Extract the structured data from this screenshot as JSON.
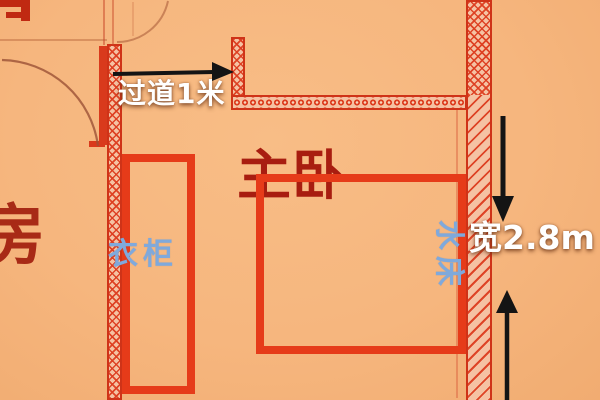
{
  "floorplan": {
    "annotations": {
      "corridor_dimension": "过道1米",
      "width_dimension": "宽2.8m"
    },
    "rooms": {
      "master_bedroom": "主卧",
      "adjacent_room_partial": "房"
    },
    "furniture": {
      "wardrobe": "衣柜",
      "bed": "水床"
    },
    "icons": {
      "arrow_right": "black arrow pointing right along corridor",
      "arrow_down": "black arrow pointing down (top of width dimension)",
      "arrow_up": "black arrow pointing up (bottom of width dimension)",
      "door_swing_arc": "quarter-circle door swing",
      "hatched_wall": "red hatched structural wall"
    },
    "colors": {
      "background": "#f6b67e",
      "wall_red": "#cf3318",
      "wall_fill": "#f5c2a3",
      "furniture_red": "#e63b19",
      "room_text_red": "#a81d10",
      "label_blue": "#7fa9dc",
      "dimension_text_white": "#ffffff",
      "arrow_black": "#141414"
    }
  }
}
